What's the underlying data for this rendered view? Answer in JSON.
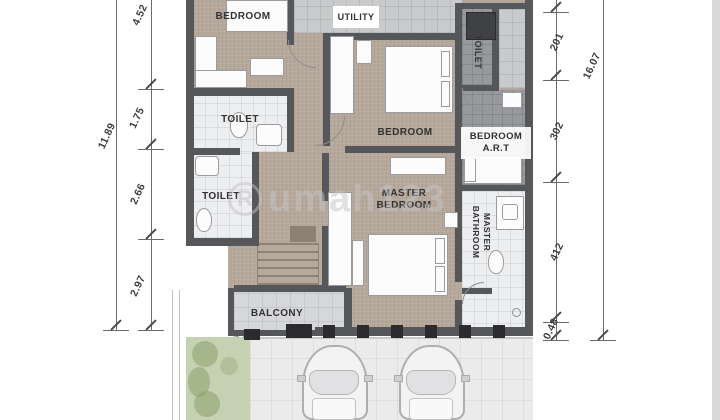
{
  "plan": {
    "rooms": {
      "bedroom_top_left": "BEDROOM",
      "toilet_upper_left": "TOILET",
      "toilet_lower_left": "TOILET",
      "utility": "UTILITY",
      "bedroom_middle": "BEDROOM",
      "toilet_top_right": "TOILET",
      "bedroom_art": {
        "line1": "BEDROOM",
        "line2": "A.R.T"
      },
      "master_bedroom": {
        "line1": "MASTER",
        "line2": "BEDROOM"
      },
      "master_bathroom": {
        "line1": "MASTER",
        "line2": "BATHROOM"
      },
      "balcony": "BALCONY"
    }
  },
  "dimensions": {
    "left": {
      "total": "11.89",
      "segments": [
        "4.52",
        "1.75",
        "2.66",
        "2.97"
      ]
    },
    "right": {
      "total": "16.07",
      "segments": [
        "201",
        "302",
        "412",
        "0.48"
      ]
    }
  },
  "watermark": {
    "symbol": "R",
    "text": "umah123"
  },
  "colors": {
    "wall": "#56575b",
    "wood_floor": "#b6a89b",
    "tile_light": "#edeef0",
    "tile_dark": "#97999d",
    "balcony_tile": "#d6d7d9",
    "garden": "#c6d0b2",
    "driveway": "#ebebec",
    "dimension_text": "#3e3e40",
    "watermark_gray": "#c6c6c8"
  }
}
